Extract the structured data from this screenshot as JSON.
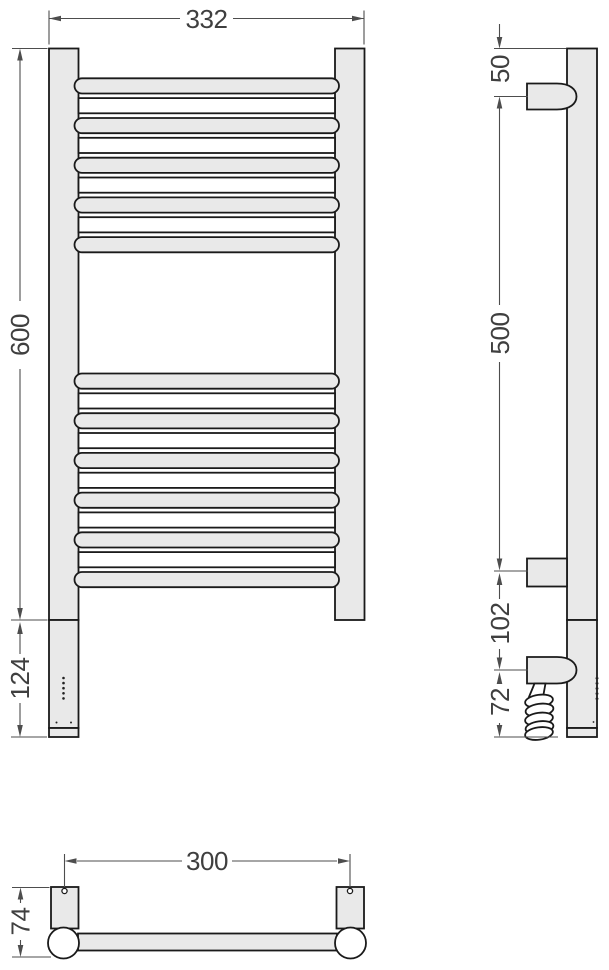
{
  "drawing": {
    "type": "technical dimension drawing",
    "subject": "ladder towel rail (heated towel warmer), front / side / bottom views",
    "colors": {
      "background": "#ffffff",
      "part_fill": "#e9e9e9",
      "part_outline": "#1a1a1a",
      "dimension_lines": "#4d4d4d",
      "dimension_text": "#3f3f3f"
    },
    "dims": {
      "overall_width": "332",
      "post_height": "600",
      "heater_section": "124",
      "top_to_bracket": "50",
      "bracket_spacing": "500",
      "bracket_to_cable_entry": "102",
      "cable_entry_to_bottom": "72",
      "mount_center_spacing": "300",
      "wall_depth": "74"
    },
    "front_view": {
      "gray_rung_tops": [
        78.3,
        118.0,
        157.7,
        197.4,
        237.1,
        373.5,
        413.2,
        452.9,
        492.6,
        532.3,
        572.0
      ],
      "white_rung_tops": [
        98.1,
        137.8,
        177.5,
        217.2,
        393.3,
        433.0,
        472.7,
        512.4,
        552.1
      ],
      "rung_height": 15.2,
      "gray_rung_x": 74.5,
      "gray_rung_width": 264.5,
      "white_rung_x": 78.5,
      "white_rung_width": 256.5
    },
    "indicator": {
      "led_dot_count": 5,
      "led_first_y": 678,
      "led_step": 5.1,
      "led_x": 63.5
    }
  }
}
